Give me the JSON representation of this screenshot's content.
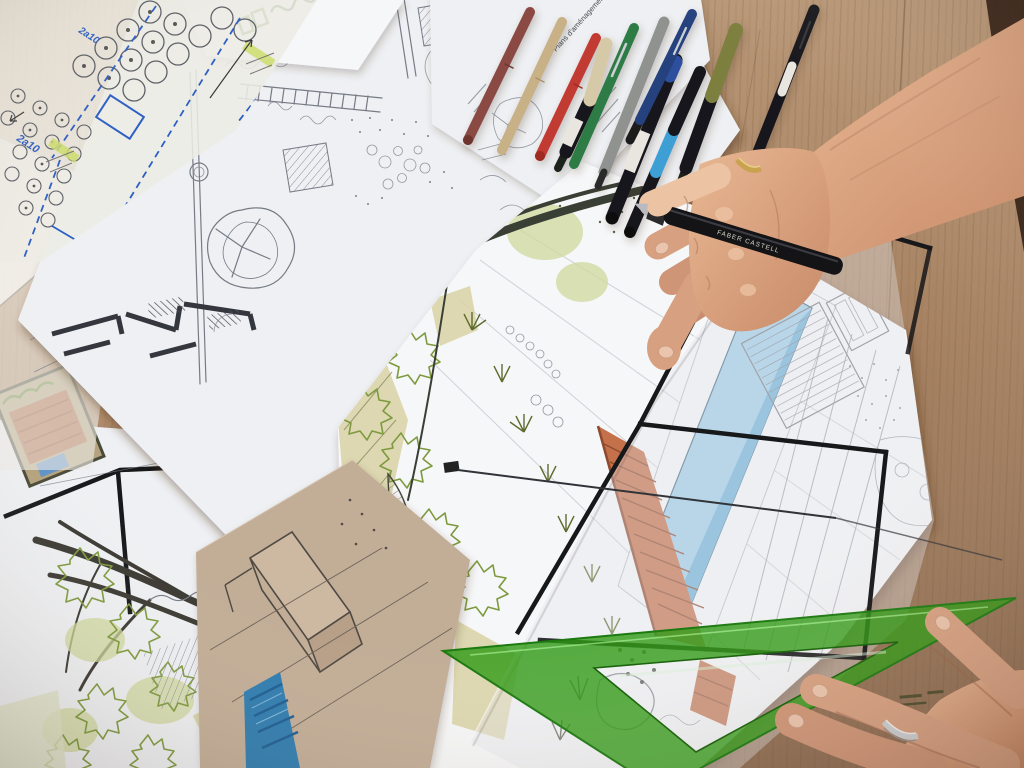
{
  "scene": {
    "description": "Overhead photo of a landscape designer's desk: hands with a fineliner pen over colored garden-plan sketches, marker pens, tracing paper overlays and a green set square on a wooden table",
    "objects": [
      "wood-desk",
      "pencil-floorplan-sheet",
      "planting-plan-tracing",
      "letterhead-paper",
      "annotation-paper",
      "marker-pens",
      "main-colored-drawing",
      "tracing-overlay",
      "kraft-sketch-paper",
      "green-set-square",
      "right-hand-with-pen",
      "left-hand"
    ]
  },
  "texts": {
    "pen_brand": "FABER CASTELL",
    "paper_heading": "Plans d'aménagement",
    "blue_note_1": "2a10",
    "blue_note_2": "2a10"
  },
  "colors": {
    "wood_base": "#b28d6c",
    "wood_light": "#c7a685",
    "wood_dark": "#96745a",
    "wood_streak": "#8a6448",
    "table_edge_dark": "#301d13",
    "paper": "#eef0f3",
    "paper_bright": "#f6f7f8",
    "tracing": "#e9e8e2",
    "kraft": "#c2ad97",
    "kraft_dark": "#ab9480",
    "pencil": "#767b85",
    "ink_dark": "#2e3137",
    "wall_dark": "#34383e",
    "leaf": "#7e9a3e",
    "leaf_dark": "#5a6a2e",
    "wash_green": "#cfd89d",
    "khaki": "#d8d2a4",
    "olive": "#8a8a5e",
    "pool": "#9fcde8",
    "pool_deep": "#6fb2d8",
    "pool_pale": "#c6e4f4",
    "pool_ink": "#2e7cb0",
    "pool_ink_dark": "#1c5d92",
    "terracotta": "#c4704a",
    "terracotta_dark": "#8e4a2c",
    "triangle": "#2f9a14",
    "triangle_edge": "#1c7a10",
    "triangle_hi": "#9fe07f",
    "skin": "#d7a081",
    "skin_light": "#ecc3a3",
    "skin_dark": "#b67c5f",
    "skin_deep": "#9c6247",
    "gold": "#c9a24f",
    "silver": "#cdd0d4",
    "blue_pen": "#2d5fc4",
    "highlight": "#cddd6e",
    "pen_maroon": "#8a4a42",
    "pen_tan": "#c9b187",
    "pen_red": "#c23a31",
    "pen_green": "#2f7c45",
    "pen_gray": "#8f928e",
    "pen_blue": "#27427e",
    "pen_cyan": "#3e9fd4",
    "pen_olive": "#7c7f3e",
    "pen_black": "#17181a",
    "pen_cream": "#d6c9a8"
  }
}
